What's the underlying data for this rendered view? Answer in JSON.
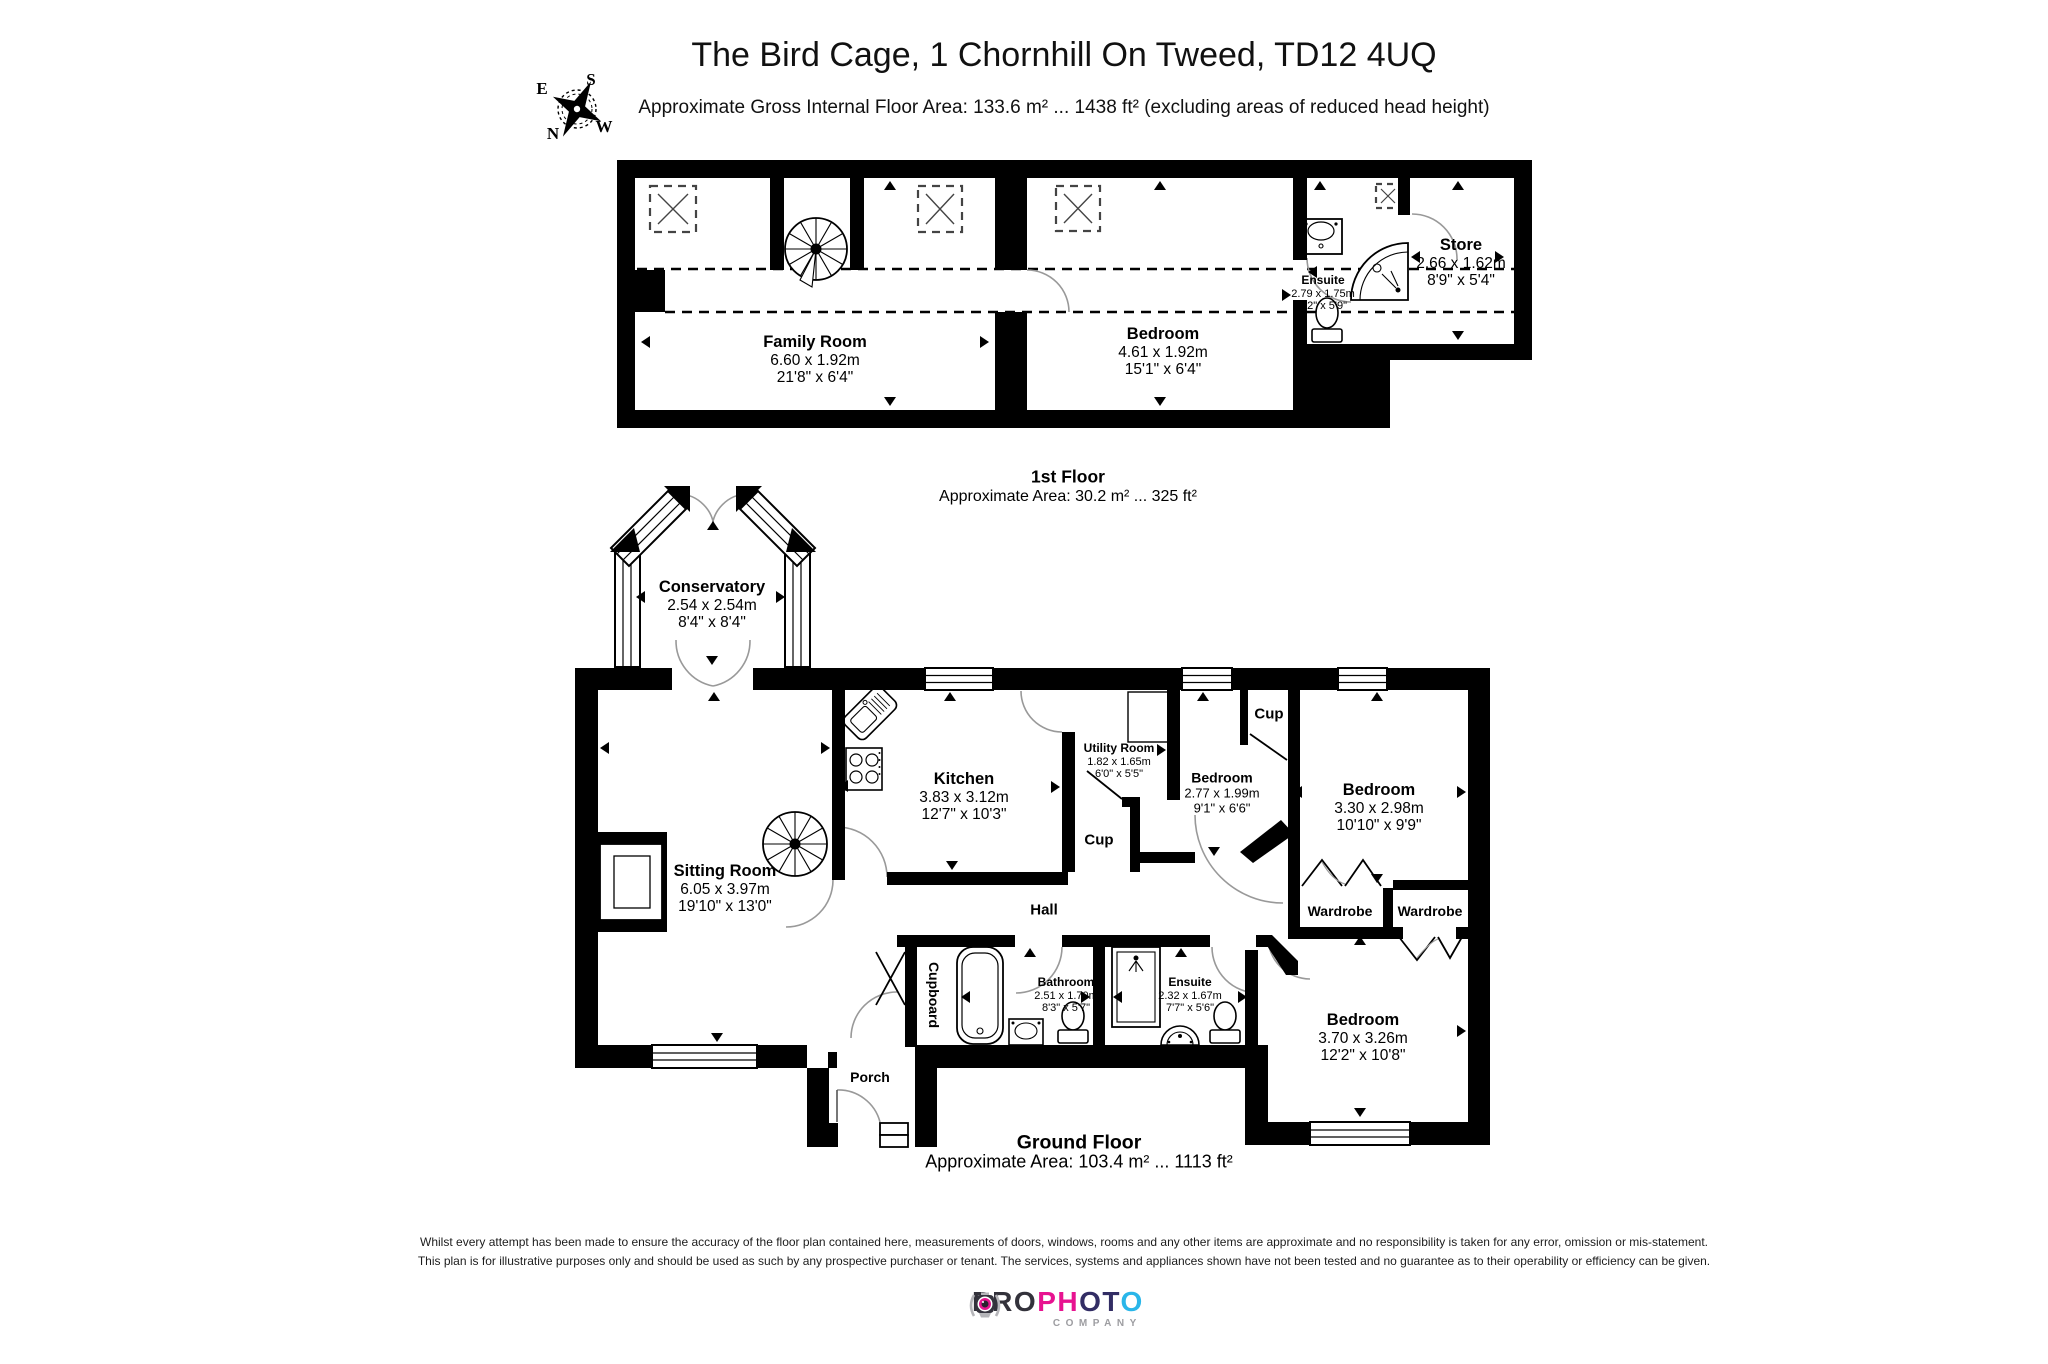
{
  "header": {
    "title": "The Bird Cage, 1 Chornhill On Tweed, TD12 4UQ",
    "subtitle": "Approximate Gross Internal Floor Area: 133.6 m² ... 1438 ft² (excluding areas of reduced head height)",
    "compass": {
      "north": "N",
      "south": "S",
      "east": "E",
      "west": "W"
    }
  },
  "first_floor": {
    "caption": "1st Floor",
    "area_caption": "Approximate Area: 30.2 m² ... 325 ft²",
    "rooms": {
      "family_room": {
        "name": "Family Room",
        "metric": "6.60 x 1.92m",
        "imperial": "21'8\" x 6'4\""
      },
      "bedroom": {
        "name": "Bedroom",
        "metric": "4.61 x 1.92m",
        "imperial": "15'1\" x 6'4\""
      },
      "ensuite": {
        "name": "Ensuite",
        "metric": "2.79 x 1.75m",
        "imperial": "9'2\" x 5'9\""
      },
      "store": {
        "name": "Store",
        "metric": "2.66 x 1.62m",
        "imperial": "8'9\" x 5'4\""
      }
    }
  },
  "ground_floor": {
    "caption": "Ground Floor",
    "area_caption": "Approximate Area: 103.4 m² ... 1113 ft²",
    "rooms": {
      "conservatory": {
        "name": "Conservatory",
        "metric": "2.54 x 2.54m",
        "imperial": "8'4\" x 8'4\""
      },
      "sitting_room": {
        "name": "Sitting Room",
        "metric": "6.05 x 3.97m",
        "imperial": "19'10\" x 13'0\""
      },
      "kitchen": {
        "name": "Kitchen",
        "metric": "3.83 x 3.12m",
        "imperial": "12'7\" x 10'3\""
      },
      "utility_room": {
        "name": "Utility Room",
        "metric": "1.82 x 1.65m",
        "imperial": "6'0\" x 5'5\""
      },
      "bedroom_small": {
        "name": "Bedroom",
        "metric": "2.77 x 1.99m",
        "imperial": "9'1\" x 6'6\""
      },
      "bedroom_right": {
        "name": "Bedroom",
        "metric": "3.30 x 2.98m",
        "imperial": "10'10\" x 9'9\""
      },
      "bedroom_bottom": {
        "name": "Bedroom",
        "metric": "3.70 x 3.26m",
        "imperial": "12'2\" x 10'8\""
      },
      "bathroom": {
        "name": "Bathroom",
        "metric": "2.51 x 1.70m",
        "imperial": "8'3\" x 5'7\""
      },
      "ensuite": {
        "name": "Ensuite",
        "metric": "2.32 x 1.67m",
        "imperial": "7'7\" x 5'6\""
      },
      "hall": {
        "name": "Hall"
      },
      "cup_kitchen": {
        "name": "Cup"
      },
      "cup_bedroom": {
        "name": "Cup"
      },
      "wardrobe_left": {
        "name": "Wardrobe"
      },
      "wardrobe_right": {
        "name": "Wardrobe"
      },
      "cupboard": {
        "name": "Cupboard"
      },
      "porch": {
        "name": "Porch"
      }
    }
  },
  "footer": {
    "disclaimer_line1": "Whilst every attempt has been made to ensure the accuracy of the floor plan contained here, measurements of doors, windows, rooms and any other items are approximate and no responsibility is taken for any error, omission or mis-statement.",
    "disclaimer_line2": "This plan is for illustrative purposes only and should be used as such by any prospective purchaser or tenant. The services, systems and appliances shown have not been tested and no guarantee as to their operability or efficiency can be given."
  },
  "logo": {
    "part1": "PRO",
    "part2": "PH",
    "part3": "OT",
    "part4": "O",
    "company": "COMPANY",
    "colors": {
      "dark": "#33323b",
      "magenta": "#e71390",
      "navy": "#322d64",
      "cyan": "#2ab6e9",
      "gray": "#9d9da1"
    }
  }
}
